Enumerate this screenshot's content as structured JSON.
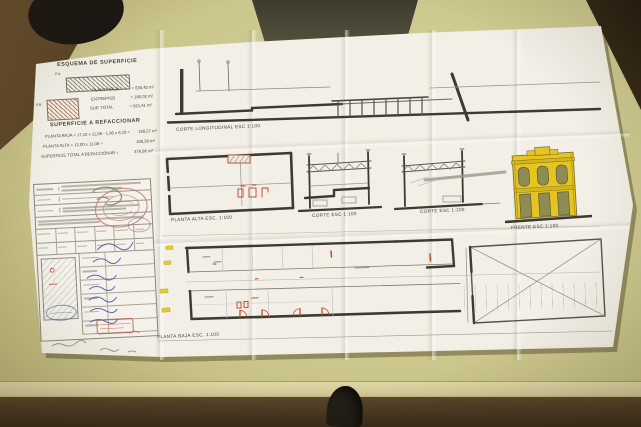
{
  "plan": {
    "esquema": {
      "title": "ESQUEMA DE SUPERFICIE",
      "tag_large": "P.A.",
      "tag_small": "P.B.",
      "rows": [
        {
          "label": "PLANTA BAJA",
          "value": "= 636,40 m²"
        },
        {
          "label": "ENTREPISO",
          "value": "= 185,02 m²"
        },
        {
          "label": "SUP. TOTAL",
          "value": "= 821,41 m²"
        }
      ]
    },
    "refaccionar": {
      "title": "SUPERFICIE A REFACCIONAR",
      "rows": [
        {
          "formula": "PLANTA BAJA = 17,10 x 11,08 - 1,90 x 8,10 =",
          "value": "190,57 m²"
        },
        {
          "formula": "PLANTA ALTA = 12,00 x 11,08 =",
          "value": "186,39 m²"
        },
        {
          "formula": "SUPERFICIE TOTAL A REFACCIONAR =",
          "value": "376,96 m²"
        }
      ]
    },
    "labels": {
      "corte_longitudinal": "CORTE LONGITUDINAL   ESC 1:100",
      "planta_alta": "PLANTA ALTA   ESC. 1:100",
      "corte_1": "CORTE   ESC 1:100",
      "corte_2": "CORTE   ESC 1:100",
      "frente": "FRENTE   ESC 1:100",
      "planta_baja": "PLANTA BAJA   ESC. 1:100"
    },
    "colors": {
      "facade_highlight": "#e6c520",
      "facade_window": "#8e8c52",
      "markup_red": "#c0402a",
      "markup_yellow": "#e3cc31",
      "paper": "#f2efe6",
      "table": "#cbc68c"
    }
  }
}
